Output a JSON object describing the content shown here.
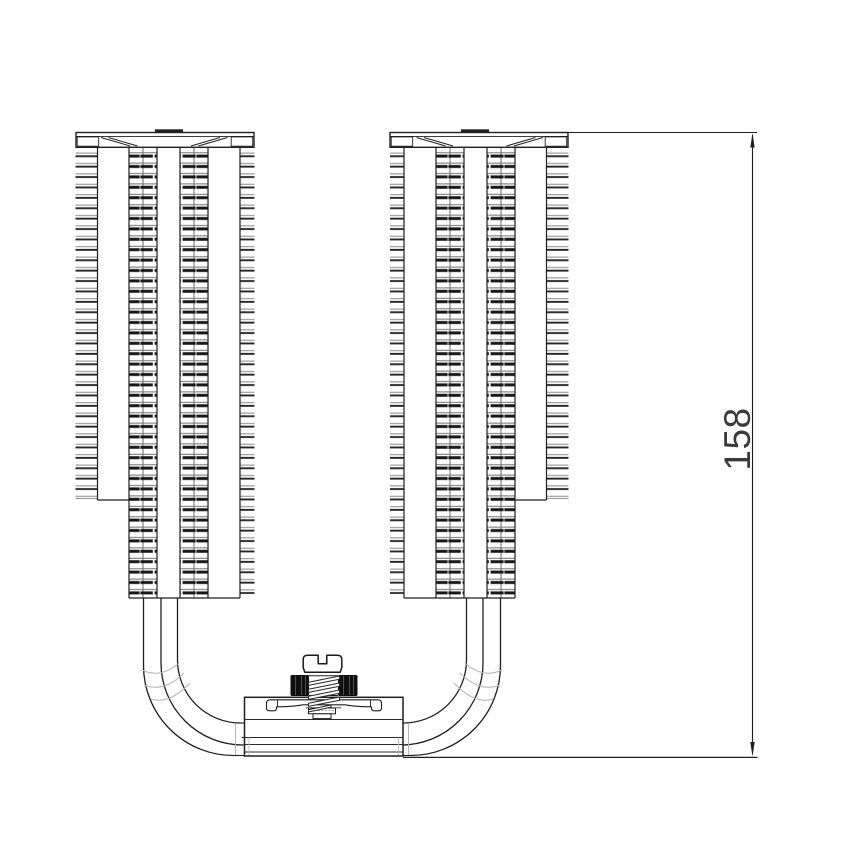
{
  "diagram": {
    "type": "technical-drawing",
    "subject": "dual-tower-cpu-cooler-front-elevation",
    "dimension": {
      "label": "158",
      "orientation": "vertical"
    }
  },
  "colors": {
    "background": "#ffffff",
    "line": "#1f1f1f",
    "fin_dark": "#181818",
    "fin_light": "#707070",
    "knurl_black": "#0f0f0f",
    "construction_gray": "#b5b5b5",
    "dimension_text": "#3a3a3a"
  }
}
